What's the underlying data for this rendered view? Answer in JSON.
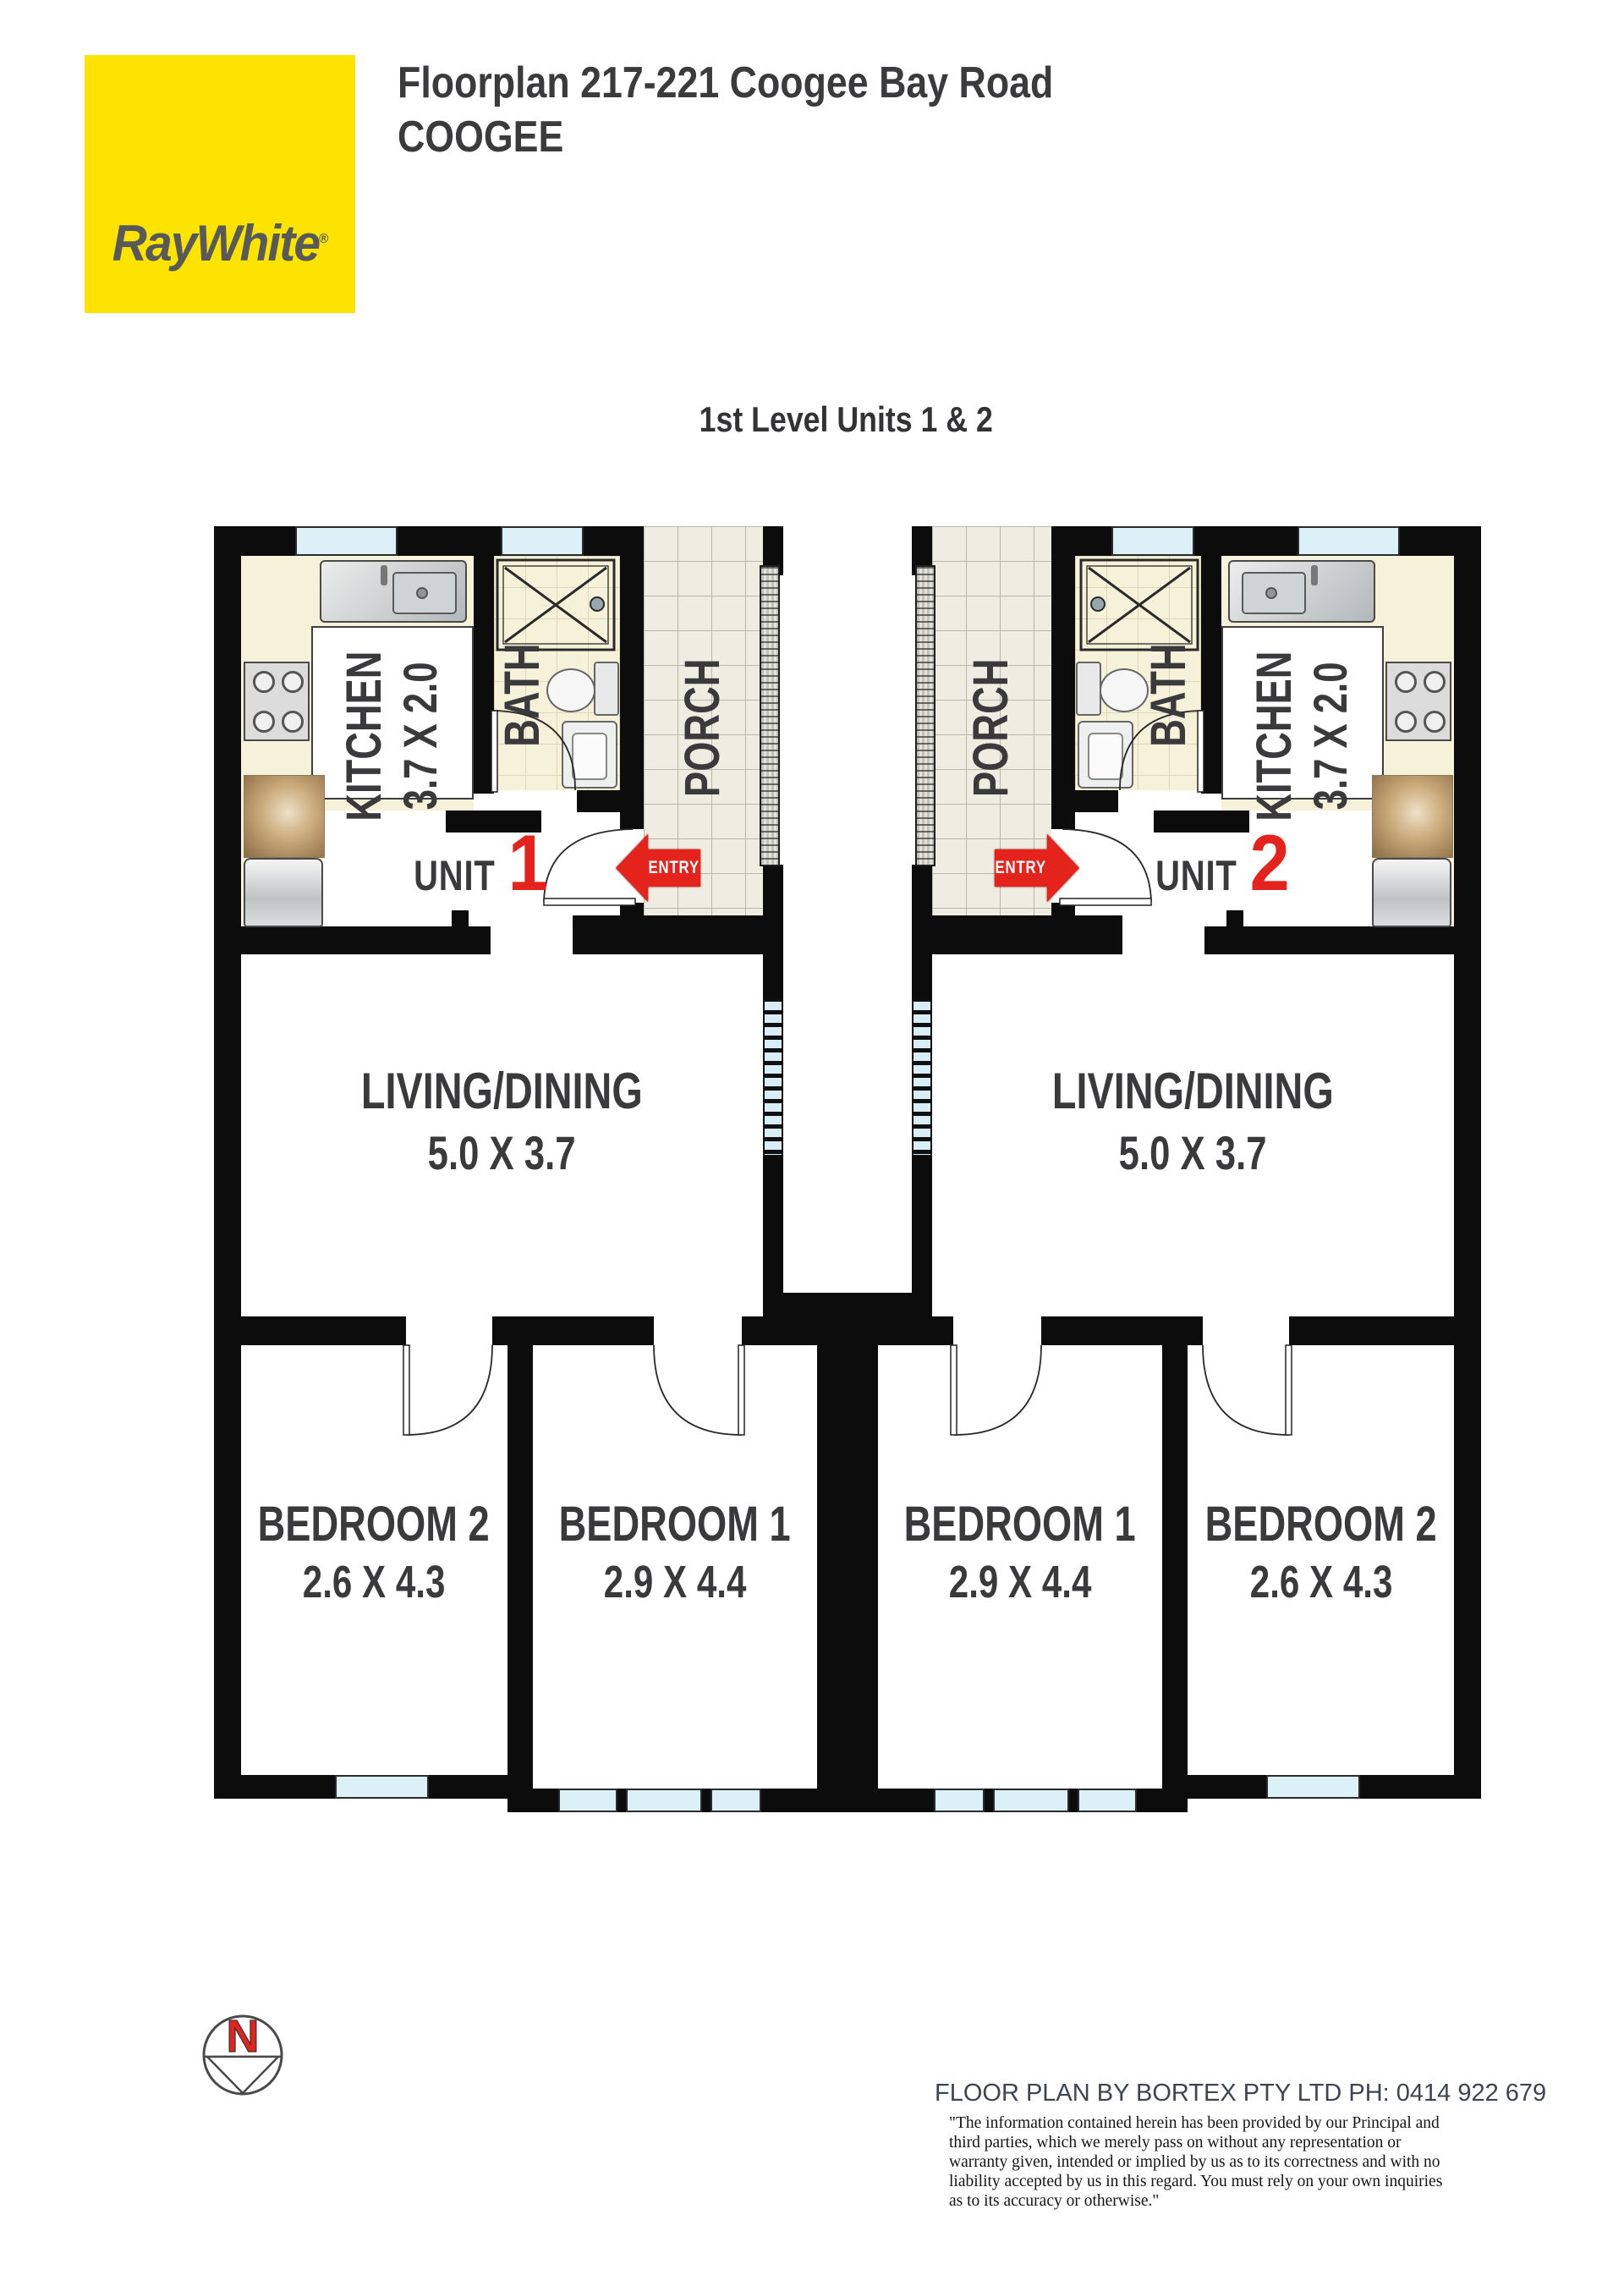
{
  "header": {
    "logo_text": "RayWhite",
    "logo_mark": "®",
    "title_line1": "Floorplan 217-221 Coogee Bay Road",
    "title_line2": "COOGEE"
  },
  "plan": {
    "subtitle": "1st Level Units 1 & 2",
    "units": [
      {
        "unit_word": "UNIT",
        "number": "1",
        "entry_label": "ENTRY",
        "kitchen": {
          "name": "KITCHEN",
          "dims": "3.7 X 2.0"
        },
        "bath": {
          "name": "BATH"
        },
        "porch": {
          "name": "PORCH"
        },
        "living": {
          "name": "LIVING/DINING",
          "dims": "5.0 X 3.7"
        },
        "bedroom1": {
          "name": "BEDROOM 1",
          "dims": "2.9 X 4.4"
        },
        "bedroom2": {
          "name": "BEDROOM 2",
          "dims": "2.6 X 4.3"
        }
      },
      {
        "unit_word": "UNIT",
        "number": "2",
        "entry_label": "ENTRY",
        "kitchen": {
          "name": "KITCHEN",
          "dims": "3.7 X 2.0"
        },
        "bath": {
          "name": "BATH"
        },
        "porch": {
          "name": "PORCH"
        },
        "living": {
          "name": "LIVING/DINING",
          "dims": "5.0 X 3.7"
        },
        "bedroom1": {
          "name": "BEDROOM 1",
          "dims": "2.9 X 4.4"
        },
        "bedroom2": {
          "name": "BEDROOM 2",
          "dims": "2.6 X 4.3"
        }
      }
    ]
  },
  "compass": {
    "north_label": "N"
  },
  "footer": {
    "credit": "FLOOR PLAN BY BORTEX PTY LTD PH: 0414 922 679",
    "disclaimer_lines": [
      "\"The information contained herein has been provided by our Principal and",
      "third parties, which we merely pass on without any representation or",
      "warranty given, intended or implied by us as to its correctness and with no",
      "liability accepted by us in this regard. You must rely on your own inquiries",
      "as to its accuracy or otherwise.\""
    ]
  },
  "colors": {
    "brand_yellow": "#FCE300",
    "accent_red": "#E3231C",
    "window_blue": "#DCF0F8",
    "wall_black": "#0C0C0C",
    "floor_cream": "#F6F1D9",
    "label_gray": "#3A3A3C"
  }
}
